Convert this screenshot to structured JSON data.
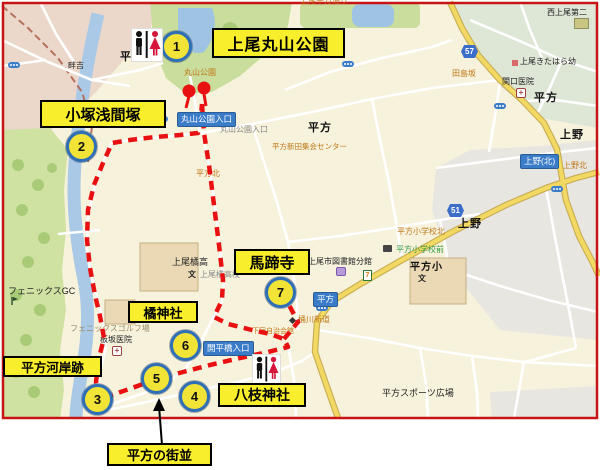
{
  "title_labels": {
    "maruyama_park": "上尾丸山公園",
    "kozuka_sengenzuka": "小塚浅間塚",
    "bateiji": "馬蹄寺",
    "tachibana_jinja": "橘神社",
    "hirakata_kashiato": "平方河岸跡",
    "yaeda_jinja": "八枝神社",
    "hirakata_machinami": "平方の街並"
  },
  "stops": [
    "1",
    "2",
    "3",
    "4",
    "5",
    "6",
    "7"
  ],
  "bus_stops": {
    "maruyama_entrance": "丸山公園入口",
    "kaiheibashi_entrance": "開平橋入口",
    "ueno_kita": "上野(北)",
    "hirakata": "平方"
  },
  "route_shields": {
    "r57": "57",
    "r51": "51"
  },
  "map_texts": {
    "azeyoshi": "畔吉",
    "hirakata_nw": "平方",
    "maruyama_koen": "丸山公園",
    "maruyama_entrance_gray": "丸山公園入口",
    "hirakata_w": "平方",
    "hirakata_ne": "平方",
    "ueno_e": "上野",
    "ueno_kita_small": "上野北",
    "ueno_s": "上野",
    "hirakata_kita": "平方北",
    "shinden_center": "平方新田集会センター",
    "nishi_ageo_daini": "西上尾第二",
    "ageo_kitahara": "上尾きたはら幼",
    "sekiguchi_clinic": "関口医院",
    "tajimazaka": "田島坂",
    "library_branch": "上尾市図書館分館",
    "hirakata_sho_kita": "平方小学校北",
    "hirakata_sho_mae": "平方小学校前",
    "hirakata_sho": "平方小",
    "tachibana_high": "上尾橘高",
    "tachibana_high_bus": "上尾橘高校",
    "phoenix_gc": "フェニックスGC",
    "phoenix_golf": "フェニックスゴルフ場",
    "itasaka_clinic": "板坂医院",
    "shimojuku": "下宿自治会館",
    "okegawa_shindo": "桶川新道",
    "sports_plaza": "平方スポーツ広場",
    "school_mark": "文",
    "top_edge_road": "上尾平方通り"
  },
  "icons": {
    "seven_eleven": "7",
    "hospital_cross": "+"
  },
  "colors": {
    "route_red": "#E81010",
    "label_yellow": "#F9EE2B",
    "stop_ring_blue": "#2F6FB6",
    "bus_label_blue": "#3A7CC8",
    "road_yellow": "#F2D964",
    "river_blue": "#A9C9E6",
    "park_green": "#C9DD9C"
  }
}
